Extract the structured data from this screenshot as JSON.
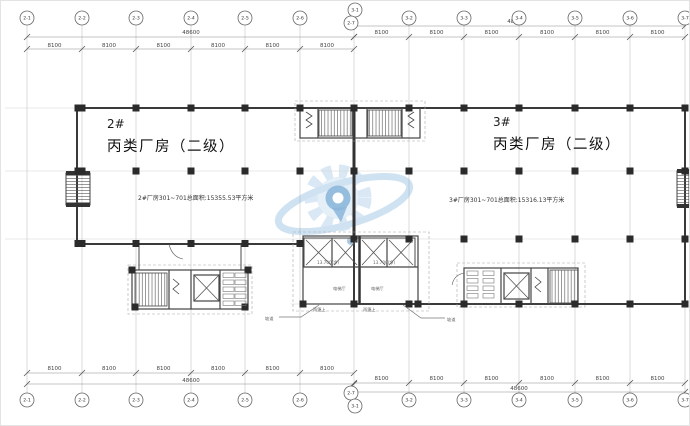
{
  "buildings": {
    "b2": {
      "number": "2#",
      "name": "丙类厂房（二级）",
      "area_note": "2#厂房301~701总面积:15355.53平方米"
    },
    "b3": {
      "number": "3#",
      "name": "丙类厂房（二级）",
      "area_note": "3#厂房301~701总面积:15316.13平方米"
    }
  },
  "grid": {
    "left_axis_labels": [
      "2-1",
      "2-2",
      "2-3",
      "2-4",
      "2-5",
      "2-6",
      "2-7"
    ],
    "right_axis_labels": [
      "3-1",
      "3-2",
      "3-3",
      "3-4",
      "3-5",
      "3-6",
      "3-7"
    ],
    "left_bay_dims": [
      "8100",
      "8100",
      "8100",
      "8100",
      "8100",
      "8100"
    ],
    "right_bay_dims": [
      "8100",
      "8100",
      "8100",
      "8100",
      "8100",
      "8100"
    ],
    "left_total_dim": "48600",
    "right_total_dim": "48600"
  },
  "annotations": {
    "canopy_label_left": "雨篷上",
    "ramp_label_left": "坡道",
    "canopy_label_right": "雨篷上",
    "ramp_label_right": "坡道",
    "elevator_lobby_left": "电梯厅",
    "elevator_lobby_right": "电梯厅",
    "level_note_left": "13.700(净)",
    "level_note_right": "13.700(净)"
  },
  "watermark": {
    "primary_color": "#2e7cbe",
    "light_color": "#a9cbe6",
    "ring_color": "#6ea8d8"
  }
}
